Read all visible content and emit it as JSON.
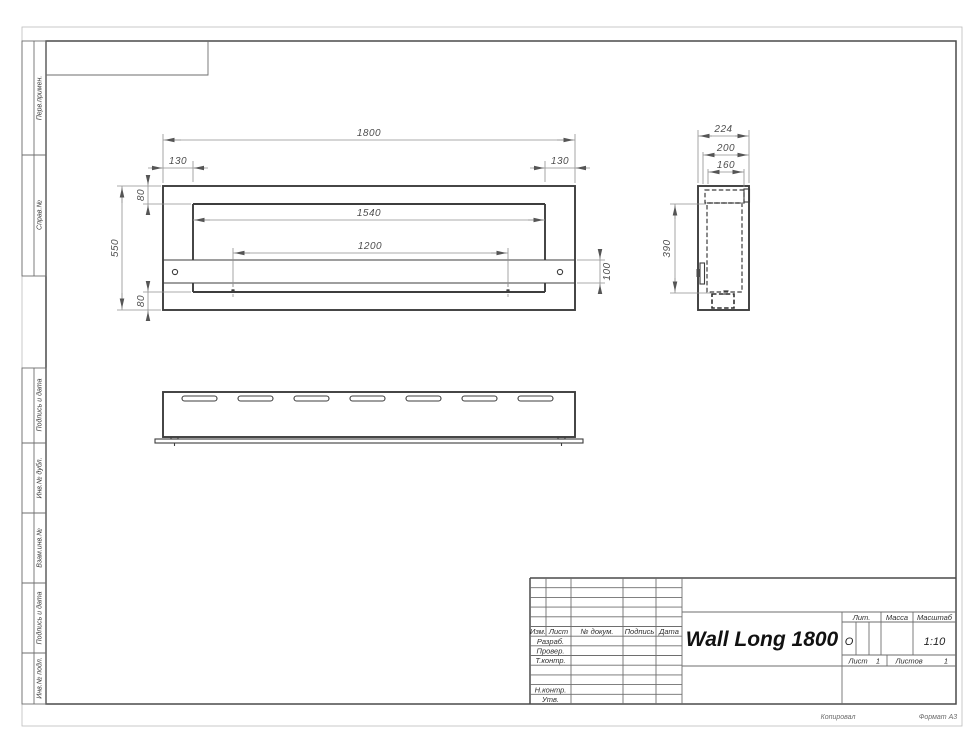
{
  "margin_labels": {
    "perv_primen": "Перв.примен.",
    "sprav_no": "Справ.№",
    "podpis_data_1": "Подпись и дата",
    "inv_dubl": "Инв.№ дубл.",
    "vzam_inv": "Взам.инв.№",
    "podpis_data_2": "Подпись и дата",
    "inv_podl": "Инв.№ подл."
  },
  "title_block": {
    "col_izm": "Изм.",
    "col_list": "Лист",
    "col_docnum": "№ докум.",
    "col_sign": "Подпись",
    "col_date": "Дата",
    "row_razrab": "Разраб.",
    "row_prover": "Провер.",
    "row_tkontr": "Т.контр.",
    "row_nkontr": "Н.контр.",
    "row_utv": "Утв.",
    "doc_title": "Wall Long 1800",
    "lit_label": "Лит.",
    "lit_value": "О",
    "mass_label": "Масса",
    "scale_label": "Масштаб",
    "scale_value": "1:10",
    "sheet_label": "Лист",
    "sheet_number": "1",
    "sheets_label": "Листов",
    "sheets_total": "1",
    "copied": "Копировал",
    "format": "Формат А3"
  },
  "front_view": {
    "dim_total_width": "1800",
    "dim_left_offset": "130",
    "dim_right_offset": "130",
    "dim_top_border": "80",
    "dim_opening_width": "1540",
    "dim_holes_span": "1200",
    "dim_height": "550",
    "dim_bottom_border": "80",
    "dim_burner_height": "100"
  },
  "side_view": {
    "dim_depth": "224",
    "dim_depth_200": "200",
    "dim_depth_160": "160",
    "dim_opening_height": "390"
  }
}
